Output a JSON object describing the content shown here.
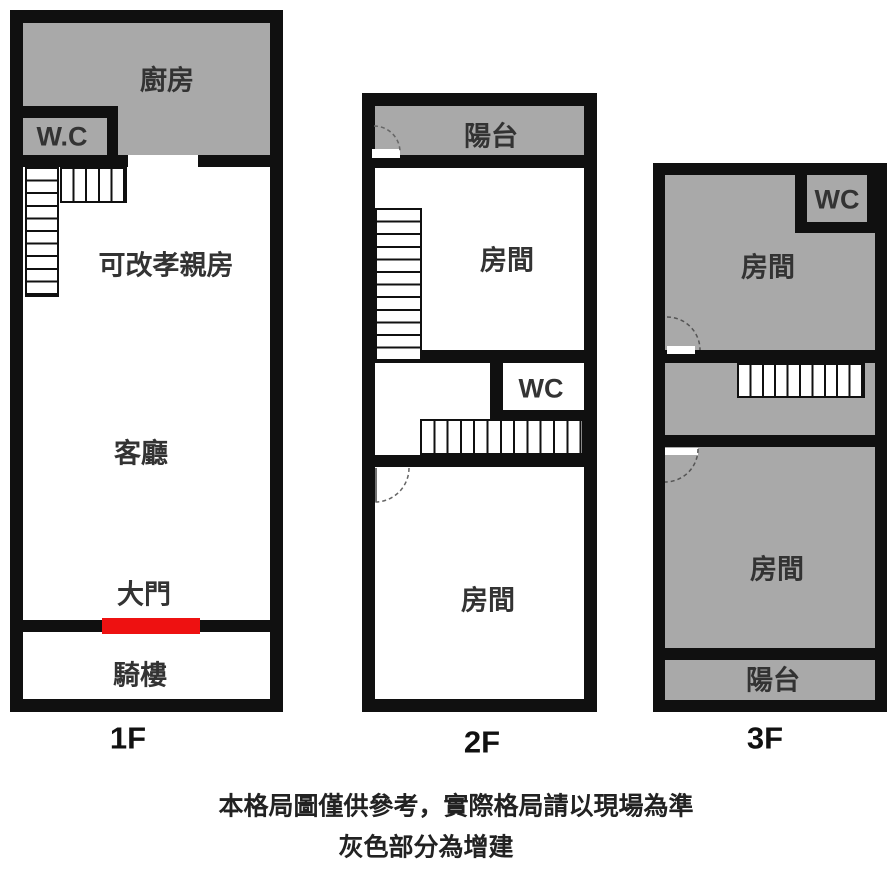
{
  "note": {
    "line1": "本格局圖僅供參考，實際格局請以現場為準",
    "line2": "灰色部分為增建"
  },
  "colors": {
    "wall": "#101010",
    "addition_gray": "#a9a9a9",
    "main_door_red": "#ee1111"
  },
  "floors": [
    {
      "label": "1F",
      "rooms": {
        "kitchen": "廚房",
        "wc": "W.C",
        "flex_room": "可改孝親房",
        "living_room": "客廳",
        "main_door": "大門",
        "arcade": "騎樓"
      }
    },
    {
      "label": "2F",
      "rooms": {
        "balcony": "陽台",
        "room_upper": "房間",
        "wc": "WC",
        "room_lower": "房間"
      }
    },
    {
      "label": "3F",
      "rooms": {
        "room_upper": "房間",
        "wc": "WC",
        "room_lower": "房間",
        "balcony": "陽台"
      }
    }
  ]
}
